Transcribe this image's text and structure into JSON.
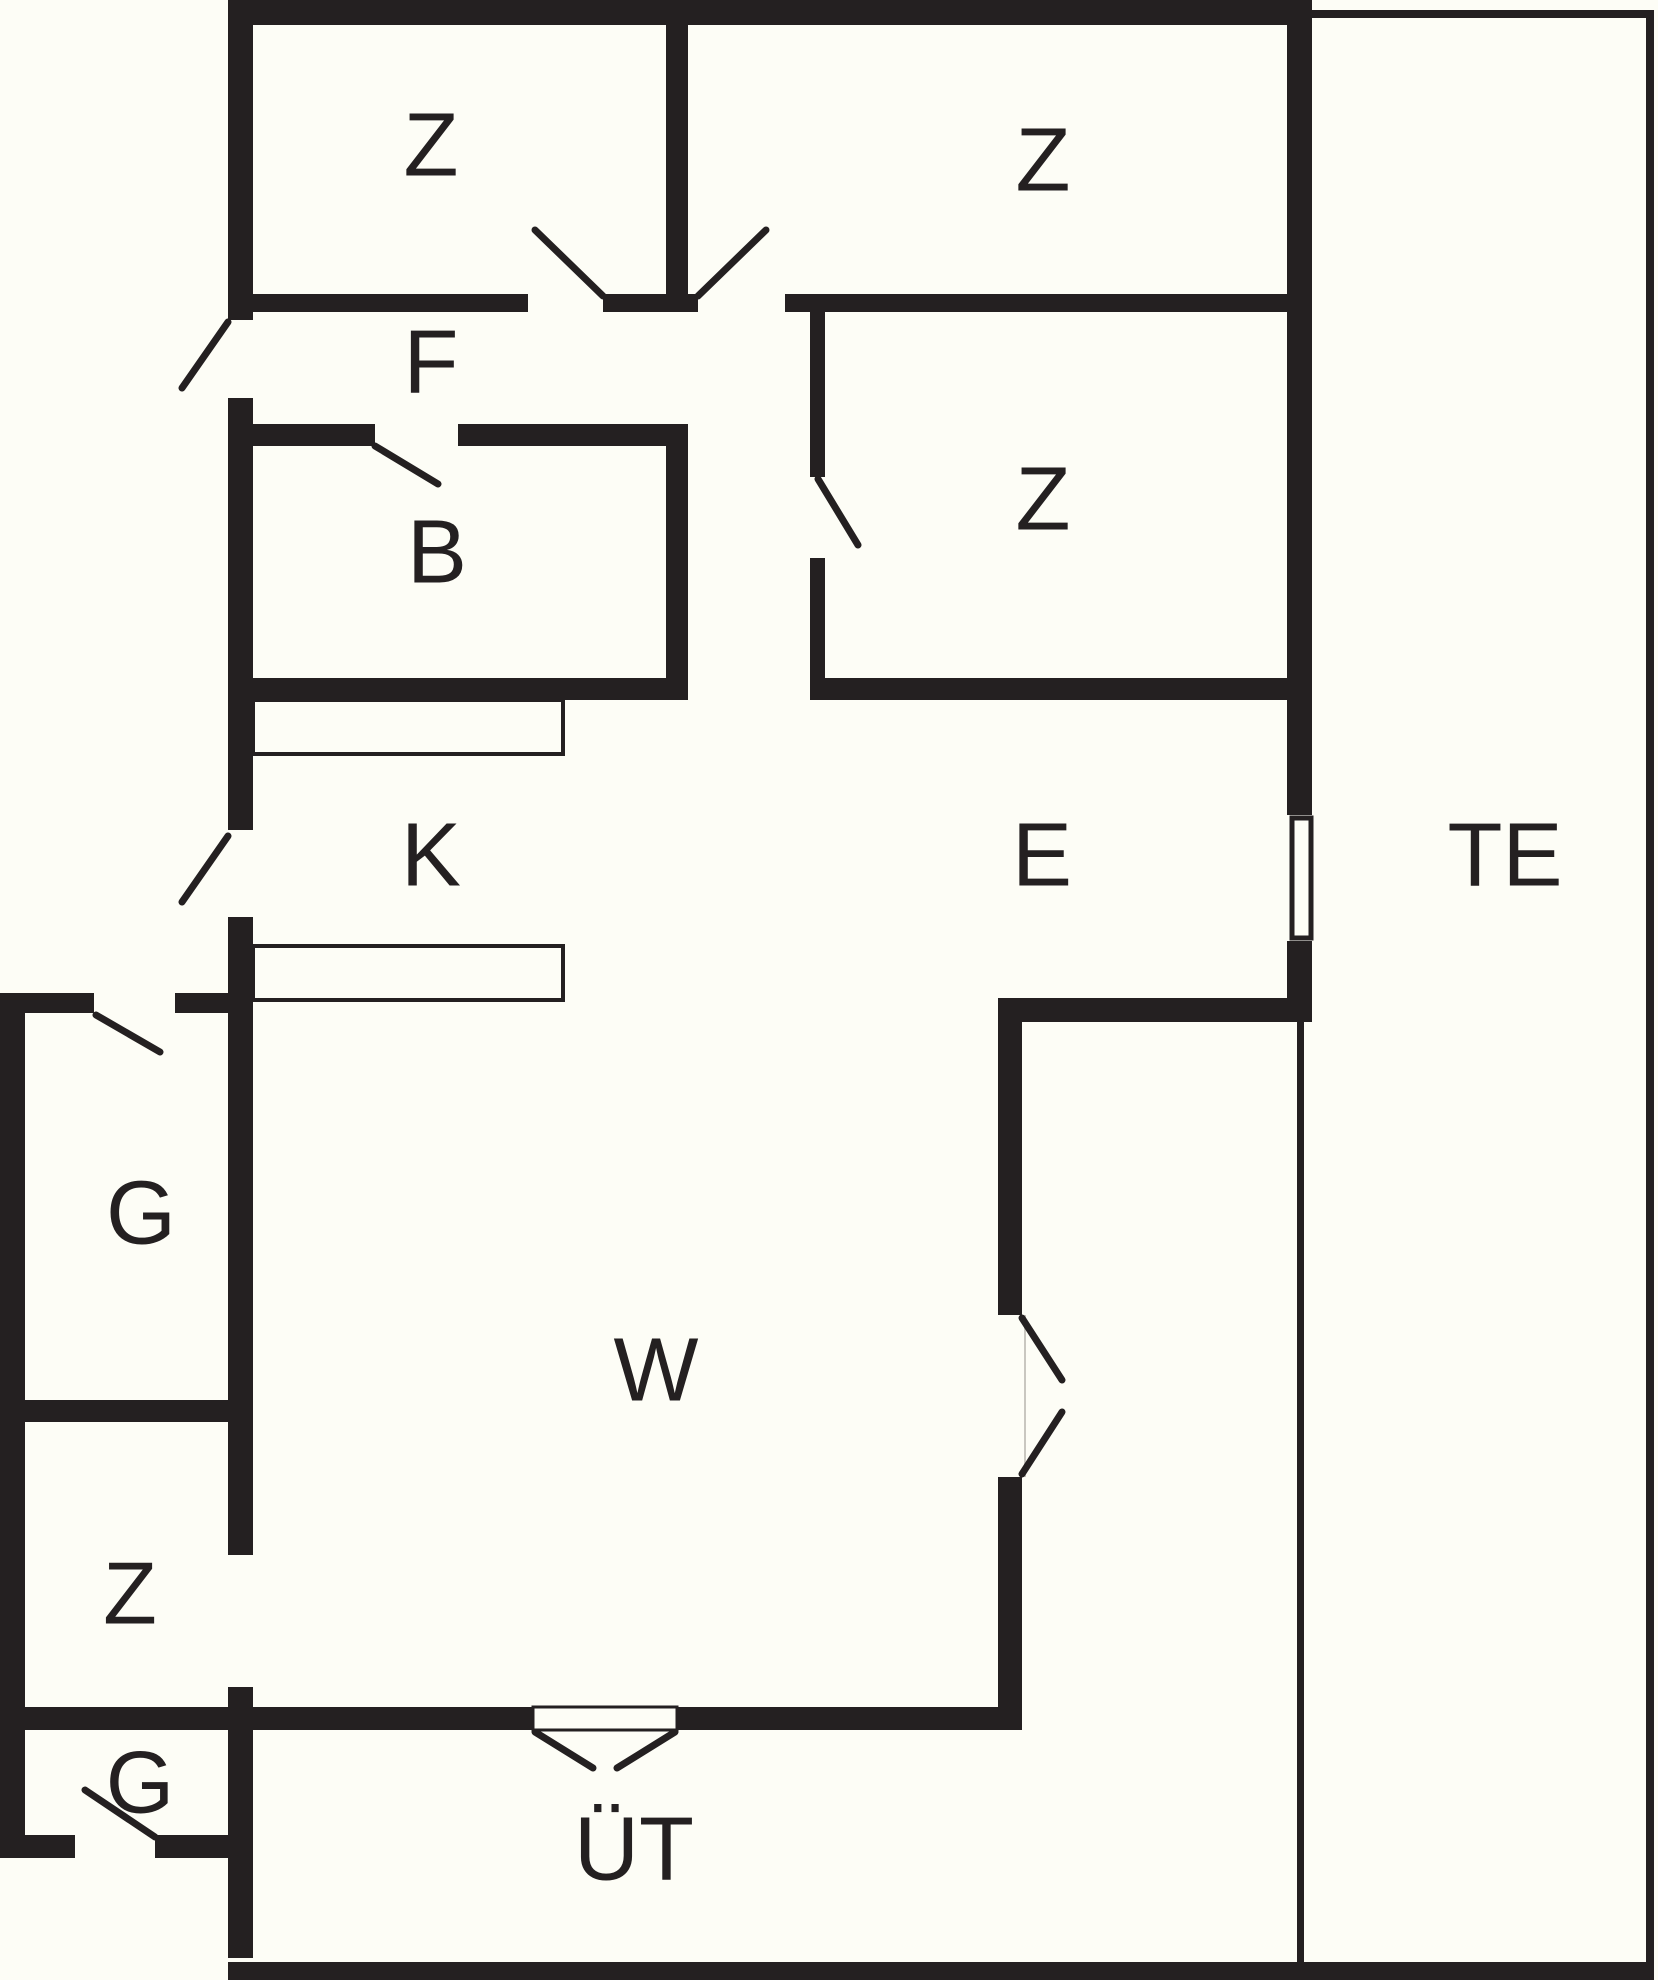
{
  "plan": {
    "title": "floor-plan",
    "canvas": {
      "width": 1658,
      "height": 1980
    },
    "colors": {
      "background": "#FDFDF6",
      "wall": "#242021",
      "swing": "#242021",
      "fixture_stroke": "#242021",
      "gap_edge": "#c9c7c0"
    },
    "label_font_size": 90,
    "rooms": [
      {
        "id": "bedroom-top-left",
        "label": "Z",
        "x": 431,
        "y": 143,
        "size": 90
      },
      {
        "id": "bedroom-top-right",
        "label": "Z",
        "x": 1043,
        "y": 158,
        "size": 90
      },
      {
        "id": "hallway",
        "label": "F",
        "x": 431,
        "y": 360,
        "size": 90
      },
      {
        "id": "bathroom",
        "label": "B",
        "x": 437,
        "y": 550,
        "size": 90
      },
      {
        "id": "bedroom-middle",
        "label": "Z",
        "x": 1043,
        "y": 497,
        "size": 90
      },
      {
        "id": "kitchen",
        "label": "K",
        "x": 431,
        "y": 853,
        "size": 90
      },
      {
        "id": "entry",
        "label": "E",
        "x": 1042,
        "y": 853,
        "size": 90
      },
      {
        "id": "terrace",
        "label": "TE",
        "x": 1505,
        "y": 853,
        "size": 90
      },
      {
        "id": "storage-upper",
        "label": "G",
        "x": 141,
        "y": 1211,
        "size": 90
      },
      {
        "id": "living-room",
        "label": "W",
        "x": 656,
        "y": 1368,
        "size": 90
      },
      {
        "id": "bedroom-annex",
        "label": "Z",
        "x": 130,
        "y": 1592,
        "size": 88
      },
      {
        "id": "storage-lower",
        "label": "G",
        "x": 140,
        "y": 1781,
        "size": 88
      },
      {
        "id": "covered-terrace",
        "label": "ÜT",
        "x": 634,
        "y": 1847,
        "size": 90
      }
    ],
    "walls": [
      {
        "name": "top-wall",
        "x": 228,
        "y": 0,
        "w": 1084,
        "h": 25
      },
      {
        "name": "west-wall-upper",
        "x": 228,
        "y": 0,
        "w": 25,
        "h": 320
      },
      {
        "name": "west-wall-mid",
        "x": 228,
        "y": 398,
        "w": 25,
        "h": 432
      },
      {
        "name": "west-wall-lower",
        "x": 228,
        "y": 917,
        "w": 25,
        "h": 638
      },
      {
        "name": "west-wall-south",
        "x": 228,
        "y": 1687,
        "w": 25,
        "h": 271
      },
      {
        "name": "east-wall-upper",
        "x": 1287,
        "y": 0,
        "w": 25,
        "h": 815
      },
      {
        "name": "east-wall-lower",
        "x": 1287,
        "y": 941,
        "w": 25,
        "h": 81
      },
      {
        "name": "zrooms-bottom-left",
        "x": 253,
        "y": 294,
        "w": 275,
        "h": 18
      },
      {
        "name": "zrooms-bottom-mid",
        "x": 603,
        "y": 294,
        "w": 95,
        "h": 18
      },
      {
        "name": "zrooms-bottom-right",
        "x": 785,
        "y": 294,
        "w": 502,
        "h": 18
      },
      {
        "name": "bedroom-divider",
        "x": 666,
        "y": 25,
        "w": 22,
        "h": 269
      },
      {
        "name": "bath-east-wall",
        "x": 666,
        "y": 424,
        "w": 22,
        "h": 276
      },
      {
        "name": "bath-top-left",
        "x": 253,
        "y": 424,
        "w": 122,
        "h": 22
      },
      {
        "name": "bath-top-right",
        "x": 458,
        "y": 424,
        "w": 208,
        "h": 22
      },
      {
        "name": "bath-bottom",
        "x": 228,
        "y": 678,
        "w": 460,
        "h": 22
      },
      {
        "name": "bed3-west-upper",
        "x": 810,
        "y": 312,
        "w": 15,
        "h": 165
      },
      {
        "name": "bed3-west-lower",
        "x": 810,
        "y": 558,
        "w": 15,
        "h": 120
      },
      {
        "name": "bed3-bottom",
        "x": 810,
        "y": 678,
        "w": 477,
        "h": 22
      },
      {
        "name": "entry-bottom",
        "x": 998,
        "y": 998,
        "w": 289,
        "h": 24
      },
      {
        "name": "living-east-upper",
        "x": 998,
        "y": 998,
        "w": 24,
        "h": 317
      },
      {
        "name": "living-east-lower",
        "x": 998,
        "y": 1477,
        "w": 24,
        "h": 253
      },
      {
        "name": "living-south-left",
        "x": 25,
        "y": 1707,
        "w": 508,
        "h": 23
      },
      {
        "name": "living-south-right",
        "x": 677,
        "y": 1707,
        "w": 345,
        "h": 23
      },
      {
        "name": "annex-top-left",
        "x": 0,
        "y": 993,
        "w": 94,
        "h": 20
      },
      {
        "name": "annex-top-right",
        "x": 175,
        "y": 993,
        "w": 78,
        "h": 20
      },
      {
        "name": "annex-west-wall",
        "x": 0,
        "y": 993,
        "w": 25,
        "h": 865
      },
      {
        "name": "annex-gz-divider",
        "x": 25,
        "y": 1400,
        "w": 203,
        "h": 22
      },
      {
        "name": "annex-bottom-left",
        "x": 0,
        "y": 1835,
        "w": 75,
        "h": 23
      },
      {
        "name": "annex-bottom-right",
        "x": 155,
        "y": 1835,
        "w": 98,
        "h": 23
      },
      {
        "name": "south-outer-wall",
        "x": 228,
        "y": 1962,
        "w": 1426,
        "h": 18
      },
      {
        "name": "terrace-top-wall",
        "x": 1312,
        "y": 10,
        "w": 341,
        "h": 8
      },
      {
        "name": "terrace-east-wall",
        "x": 1646,
        "y": 10,
        "w": 8,
        "h": 1970
      },
      {
        "name": "terrace-west-line",
        "x": 1297,
        "y": 1022,
        "w": 7,
        "h": 940
      }
    ],
    "door_swings": [
      {
        "name": "door-swing-bedroom-top-left",
        "x1": 603,
        "y1": 296,
        "x2": 535,
        "y2": 230
      },
      {
        "name": "door-swing-bedroom-top-right",
        "x1": 698,
        "y1": 296,
        "x2": 766,
        "y2": 230
      },
      {
        "name": "door-swing-hall-exterior",
        "x1": 228,
        "y1": 322,
        "x2": 182,
        "y2": 388
      },
      {
        "name": "door-swing-bathroom",
        "x1": 375,
        "y1": 446,
        "x2": 438,
        "y2": 484
      },
      {
        "name": "door-swing-bedroom-middle",
        "x1": 818,
        "y1": 479,
        "x2": 858,
        "y2": 545
      },
      {
        "name": "door-swing-kitchen-exterior",
        "x1": 228,
        "y1": 836,
        "x2": 182,
        "y2": 902
      },
      {
        "name": "door-swing-storage-upper",
        "x1": 96,
        "y1": 1015,
        "x2": 160,
        "y2": 1052
      },
      {
        "name": "door-swing-living-east-top",
        "x1": 1022,
        "y1": 1318,
        "x2": 1062,
        "y2": 1380
      },
      {
        "name": "door-swing-living-east-bottom",
        "x1": 1022,
        "y1": 1474,
        "x2": 1062,
        "y2": 1412
      },
      {
        "name": "door-swing-living-south-left",
        "x1": 535,
        "y1": 1732,
        "x2": 593,
        "y2": 1768
      },
      {
        "name": "door-swing-living-south-right",
        "x1": 675,
        "y1": 1732,
        "x2": 617,
        "y2": 1768
      },
      {
        "name": "door-swing-storage-lower",
        "x1": 155,
        "y1": 1837,
        "x2": 85,
        "y2": 1790
      }
    ],
    "fixtures": {
      "counters": [
        {
          "name": "kitchen-counter-upper",
          "x": 253,
          "y": 700,
          "w": 310,
          "h": 54
        },
        {
          "name": "kitchen-counter-lower",
          "x": 253,
          "y": 946,
          "w": 310,
          "h": 54
        }
      ],
      "terrace_door_leaf": {
        "name": "terrace-door-leaf",
        "x": 1292,
        "y": 818,
        "w": 19,
        "h": 120
      },
      "south_door_threshold": {
        "name": "south-door-threshold",
        "x": 533,
        "y": 1707,
        "w": 144,
        "h": 23
      },
      "east_gap_edge": {
        "name": "east-door-gap-edge",
        "x1": 1025,
        "y1": 1315,
        "x2": 1025,
        "y2": 1477
      }
    }
  }
}
